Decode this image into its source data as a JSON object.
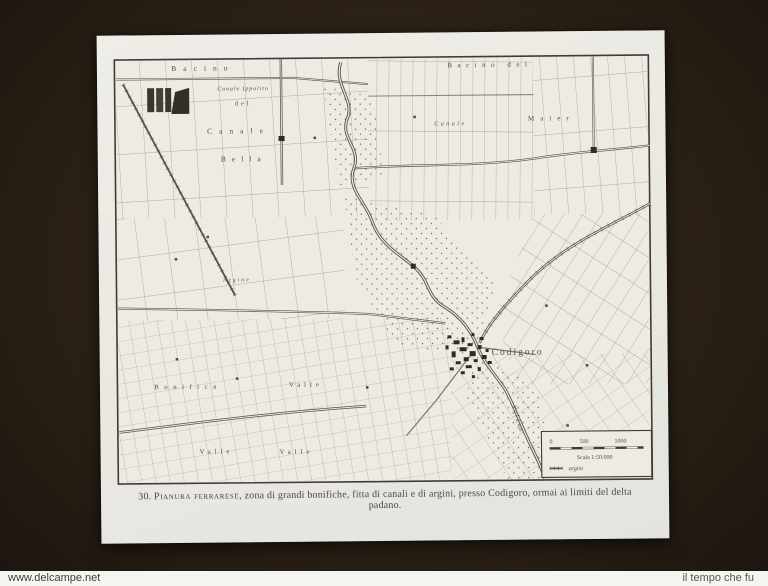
{
  "print": {
    "caption": {
      "number": "30.",
      "title": "Pianura ferrarese",
      "rest": ", zona di grandi bonifiche, fitta di canali e di argini, presso Codigoro, ormai ai limiti del delta padano."
    }
  },
  "map": {
    "labels": [
      {
        "name": "bacino-top-left",
        "text": "Bacino"
      },
      {
        "name": "del-top-left",
        "text": "del"
      },
      {
        "name": "canale-ippolito",
        "text": "Canale Ippolito"
      },
      {
        "name": "canale-left",
        "text": "Canale"
      },
      {
        "name": "bella",
        "text": "Bella"
      },
      {
        "name": "bacino-del-top-right",
        "text": "Bacino del"
      },
      {
        "name": "canale-right",
        "text": "Canale"
      },
      {
        "name": "maier",
        "text": "Maier"
      },
      {
        "name": "argine",
        "text": "Argine"
      },
      {
        "name": "bonifica",
        "text": "Bonifica"
      },
      {
        "name": "valle-mid",
        "text": "Valle"
      },
      {
        "name": "valle-bottom-1",
        "text": "Valle"
      },
      {
        "name": "valle-bottom-2",
        "text": "Valle"
      },
      {
        "name": "codigoro-town",
        "text": "Codigoro"
      },
      {
        "name": "volano-river",
        "text": "Volano"
      }
    ],
    "legend": {
      "ticks": [
        "0",
        "500",
        "1000"
      ],
      "scale_label": "Scala 1:50.000",
      "symbol_label": "argini"
    },
    "colors": {
      "background": "#2b2115",
      "paper": "#ebe9e2",
      "ink": "#534e46",
      "water": "#6f6a62",
      "town": "#2f2b26"
    }
  },
  "watermarks": {
    "left": "www.delcampe.net",
    "right": "il tempo che fu"
  }
}
